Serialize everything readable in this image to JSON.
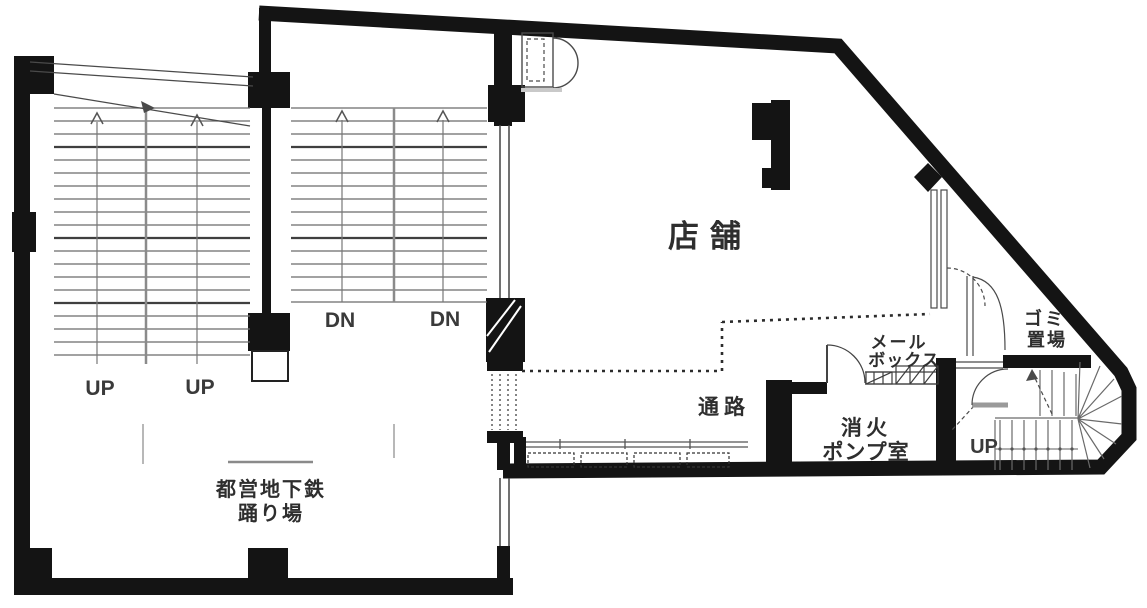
{
  "plan": {
    "kind": "floor-plan",
    "colors": {
      "wall": "#141414",
      "stair_line": "#6a6a6a",
      "text": "#2e2e2e",
      "shadow": "#c9c9c9"
    },
    "labels": {
      "shop": "店舗",
      "passage": "通路",
      "mailbox_l1": "メール",
      "mailbox_l2": "ボックス",
      "fire_pump_l1": "消火",
      "fire_pump_l2": "ポンプ室",
      "garbage_l1": "ゴミ",
      "garbage_l2": "置場",
      "subway_l1": "都営地下鉄",
      "subway_l2": "踊り場",
      "stair_left_up_1": "UP",
      "stair_left_up_2": "UP",
      "stair_mid_dn_1": "DN",
      "stair_mid_dn_2": "DN",
      "stair_right_up": "UP"
    }
  }
}
